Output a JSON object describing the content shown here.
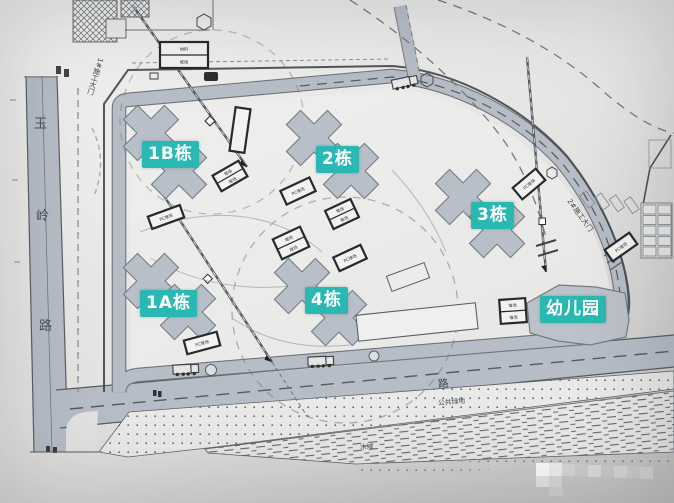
{
  "roads": {
    "left_road_name_chars": [
      "玉",
      "岭",
      "路"
    ],
    "bottom_road_char": "路"
  },
  "building_labels": [
    {
      "id": "1B",
      "text": "1B栋"
    },
    {
      "id": "2",
      "text": "2栋"
    },
    {
      "id": "3",
      "text": "3栋"
    },
    {
      "id": "1A",
      "text": "1A栋"
    },
    {
      "id": "4",
      "text": "4栋"
    },
    {
      "id": "kindergarten",
      "text": "幼儿园"
    }
  ],
  "annotations": {
    "gate1": "1#施工大门",
    "gate2": "2#施工大门",
    "green_belt": "公共绿地",
    "water": "水域",
    "pc_yard": "PC堆场",
    "yard": "堆场",
    "material": "材料"
  },
  "colors": {
    "label_bg": "#29b9b2",
    "label_text": "#ffffff",
    "road": "#b7bdc7",
    "road_edge": "#6f747c",
    "building": "#b9bfc8",
    "building_edge": "#767c84",
    "line": "#5f646b",
    "paper": "#eaeae8"
  }
}
